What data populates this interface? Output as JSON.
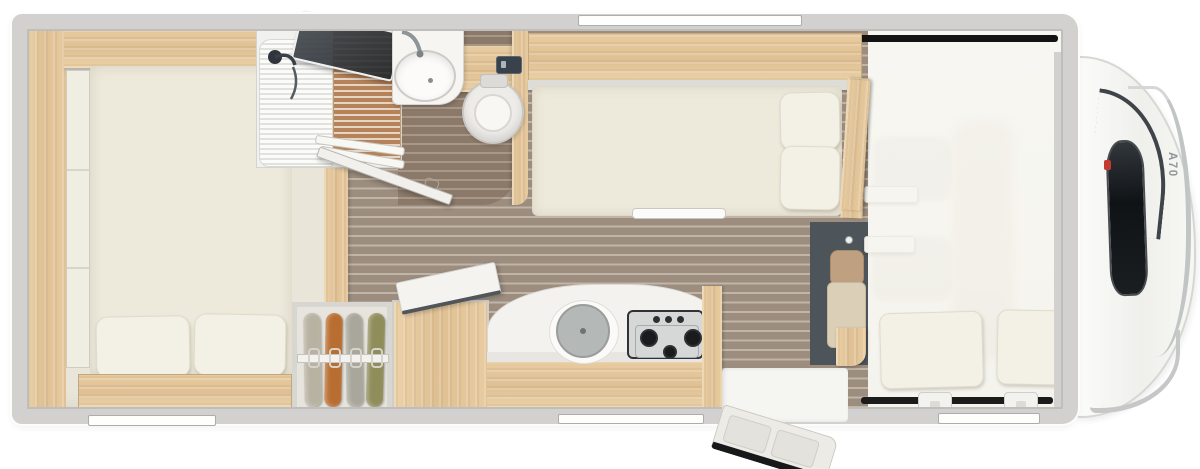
{
  "vehicle": {
    "model_label": "A70"
  },
  "palette": {
    "body_wall": "#d2d1cf",
    "wood_light": "#e5c89e",
    "floor_corridor": "#9c8d7f",
    "floor_bathroom": "#8b7969",
    "floor_stripe": "#c0b5a7",
    "shower_slats": "#b5825a",
    "mattress_cream": "#eeeadb",
    "pillow_cream": "#f3f0e5",
    "cab_floor_dark": "#4d555a",
    "stove_steel": "#d5d8d7",
    "burner_black": "#191b1c",
    "windshield_dark": "#1a1e21",
    "accent_red": "#c23a32"
  },
  "zones": [
    "rear-bedroom",
    "rear-wardrobe",
    "shower-cabin",
    "washbasin",
    "toilet",
    "bathroom",
    "corridor",
    "hanging-wardrobe",
    "kitchen-unit",
    "single-bench-bed",
    "travel-seat",
    "entry-door",
    "cab",
    "alcove-bed",
    "vehicle-front"
  ],
  "fixtures": {
    "stove_burner_count": 3,
    "stove_knob_count": 3,
    "rear_bed_pillow_count": 2,
    "alcove_pillow_count": 2,
    "window_count": 4,
    "wardrobe_garment_colors": [
      "#b8b2a2",
      "#b96e31",
      "#a9a79b",
      "#8f8d5a"
    ]
  },
  "icons": {
    "shower_head": "shower-head-icon",
    "faucet": "faucet-icon",
    "brand_badge": "red-badge"
  }
}
